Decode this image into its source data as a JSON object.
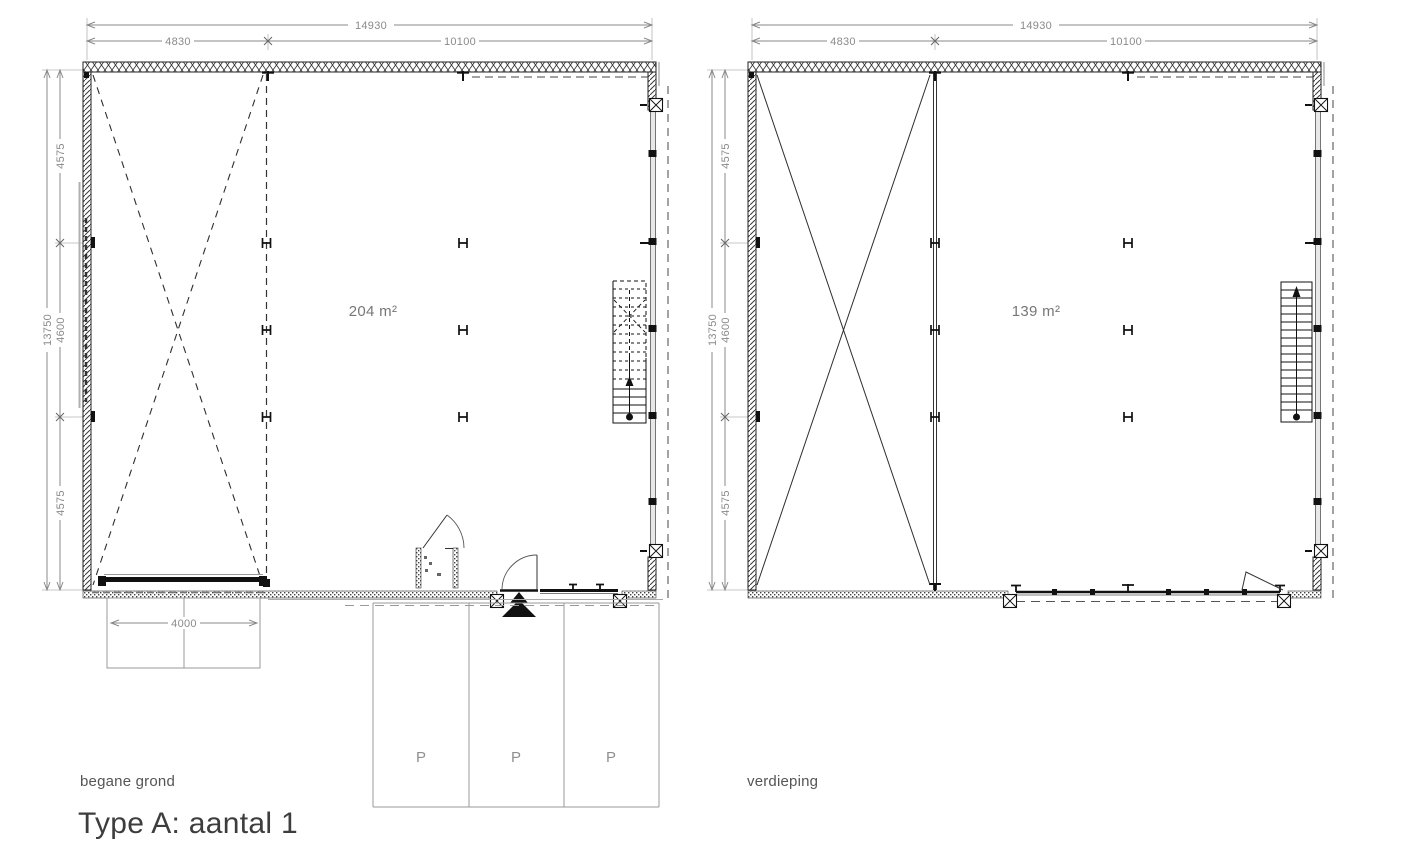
{
  "title": "Type A: aantal 1",
  "colors": {
    "background": "#ffffff",
    "line": "#222222",
    "dimension": "#8a8a8a"
  },
  "plans": [
    {
      "label": "begane grond",
      "area": "204 m²",
      "dims": {
        "width_total": "14930",
        "width_left": "4830",
        "width_right": "10100",
        "height_total": "13750",
        "height_top": "4575",
        "height_mid": "4600",
        "height_bottom": "4575",
        "door_width": "4000"
      },
      "parking_labels": [
        "P",
        "P",
        "P"
      ]
    },
    {
      "label": "verdieping",
      "area": "139 m²",
      "dims": {
        "width_total": "14930",
        "width_left": "4830",
        "width_right": "10100",
        "height_total": "13750",
        "height_top": "4575",
        "height_mid": "4600",
        "height_bottom": "4575"
      }
    }
  ]
}
